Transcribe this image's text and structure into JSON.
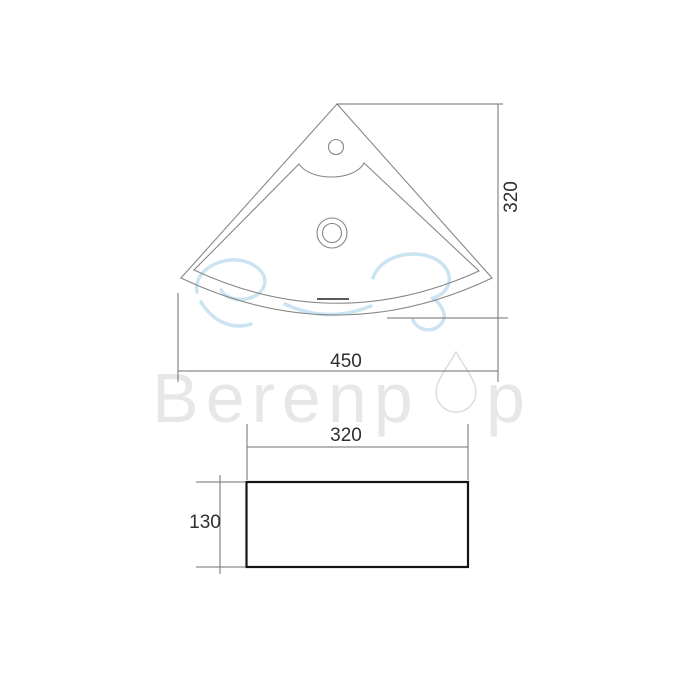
{
  "page": {
    "background": "#ffffff"
  },
  "watermark": {
    "brand_full_name": "Berenpop",
    "brand_prefix": "Berenp",
    "brand_suffix": "p",
    "text_color": "#e7e7e7",
    "drop_outline_color": "#dedede",
    "logo_curve_color": "#badbee"
  },
  "drawing": {
    "subject": "corner wash basin dimension drawing",
    "line_color": "#878787",
    "dimension_line_color": "#6f6f6f",
    "dimension_text_color": "#2f2f2f",
    "side_view_stroke_color": "#141414",
    "views": {
      "top_view": {
        "name": "top view",
        "features": [
          "tap-hole",
          "drain-hole",
          "overflow-slot"
        ],
        "dimensions": {
          "width_mm": "450",
          "depth_mm": "320"
        }
      },
      "side_view": {
        "name": "side view",
        "dimensions": {
          "width_mm": "320",
          "height_mm": "130"
        }
      }
    }
  }
}
